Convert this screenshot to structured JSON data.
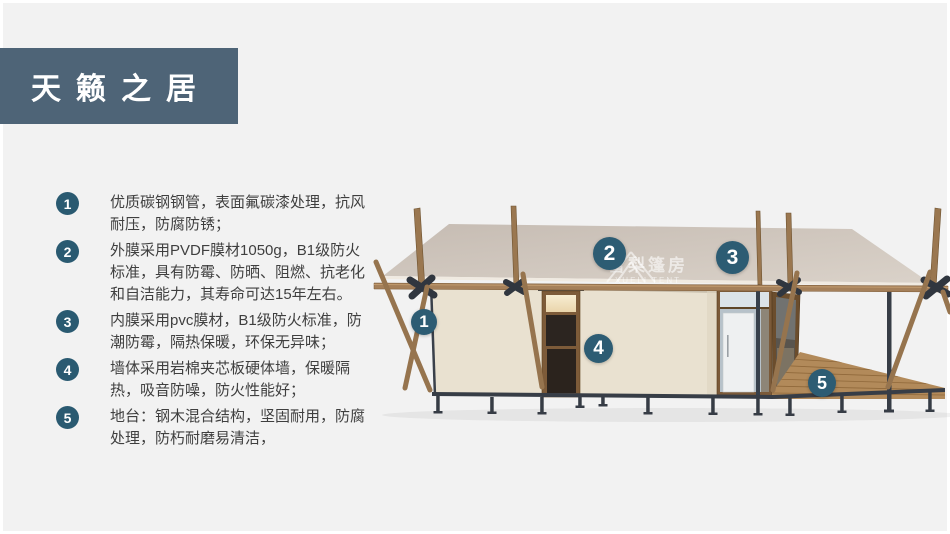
{
  "title": {
    "text": "天籁之居"
  },
  "features": [
    {
      "num": "1",
      "text": "优质碳钢钢管，表面氟碳漆处理，抗风耐压，防腐防锈；"
    },
    {
      "num": "2",
      "text": "外膜采用PVDF膜材1050g，B1级防火标准，具有防霉、防晒、阻燃、抗老化和自洁能力，其寿命可达15年左右。"
    },
    {
      "num": "3",
      "text": "内膜采用pvc膜材，B1级防火标准，防潮防霉，隔热保暖，环保无异味；"
    },
    {
      "num": "4",
      "text": "墙体采用岩棉夹芯板硬体墙，保暖隔热，吸音防噪，防火性能好；"
    },
    {
      "num": "5",
      "text": "地台：钢木混合结构，坚固耐用，防腐处理，防朽耐磨易清洁，"
    }
  ],
  "diagram": {
    "markers": [
      {
        "label": "1"
      },
      {
        "label": "2"
      },
      {
        "label": "3"
      },
      {
        "label": "4"
      },
      {
        "label": "5"
      }
    ],
    "watermark": {
      "cn": "雪梨篷房",
      "en": "XUELI TENT"
    }
  },
  "colors": {
    "page_bg": "#f2f2f2",
    "title_bg": "#4e6477",
    "accent": "#2a5a71",
    "roof": "#cfc5bc",
    "wall": "#e9e1d0",
    "wood": "#9a7750",
    "steel": "#373d46",
    "deck": "#b28a5a"
  }
}
